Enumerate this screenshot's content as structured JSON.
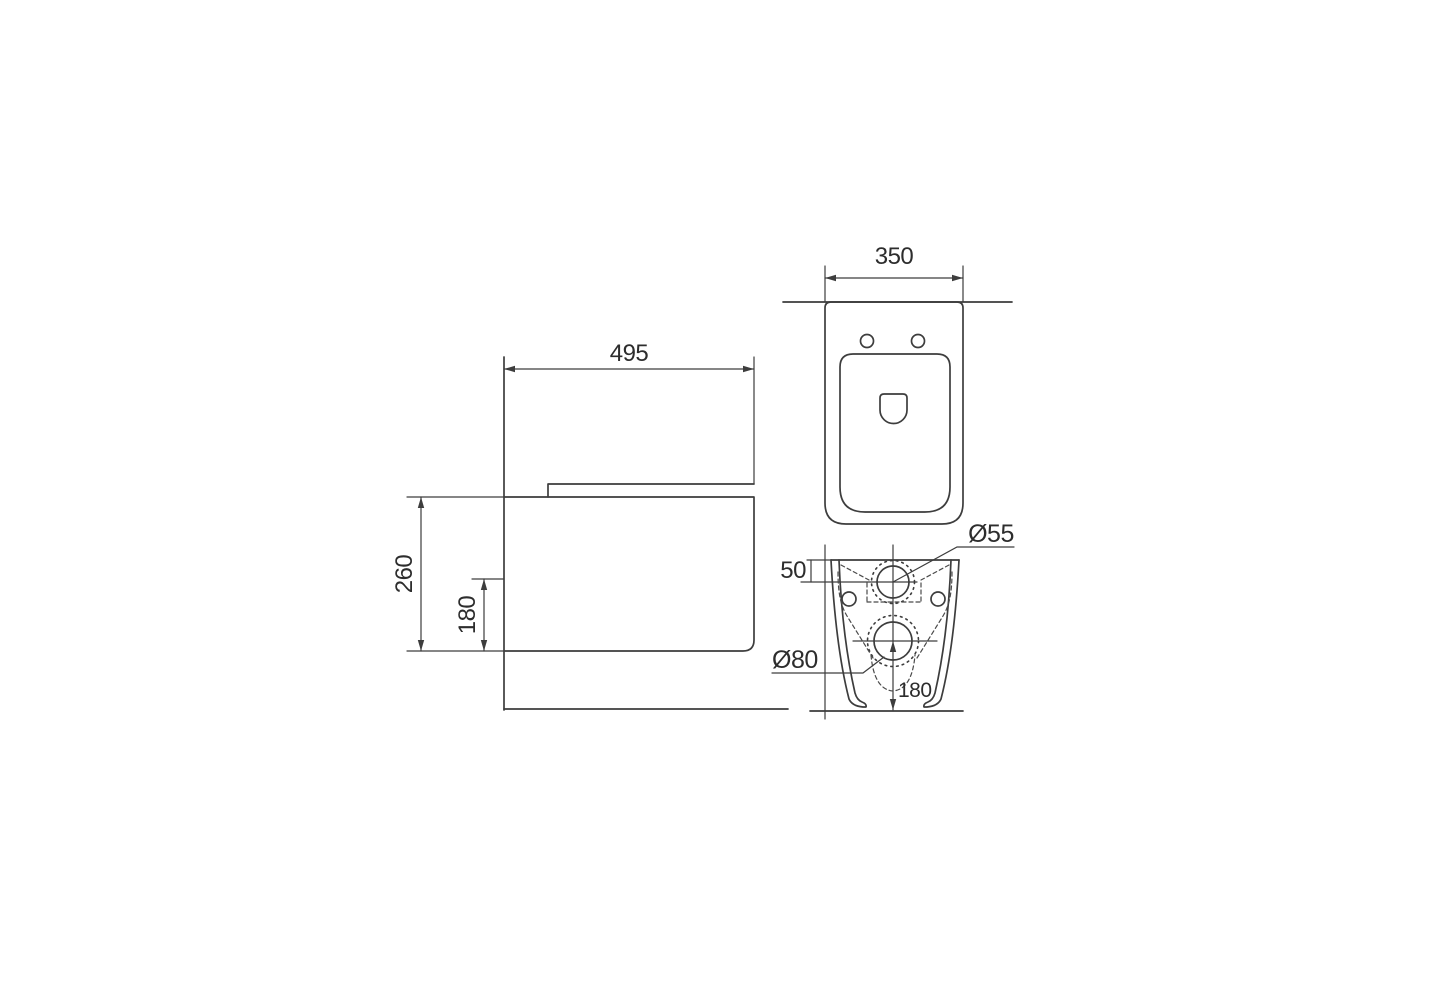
{
  "drawing": {
    "background_color": "#ffffff",
    "line_color": "#3d3d3d",
    "text_color": "#2d2d2d",
    "side_view": {
      "depth": "495",
      "height": "260",
      "outlet_height": "180"
    },
    "top_view": {
      "width": "350"
    },
    "rear_view": {
      "inlet_offset_from_top": "50",
      "inlet_diameter": "Ø55",
      "outlet_diameter": "Ø80",
      "outlet_height_from_floor": "180"
    }
  }
}
